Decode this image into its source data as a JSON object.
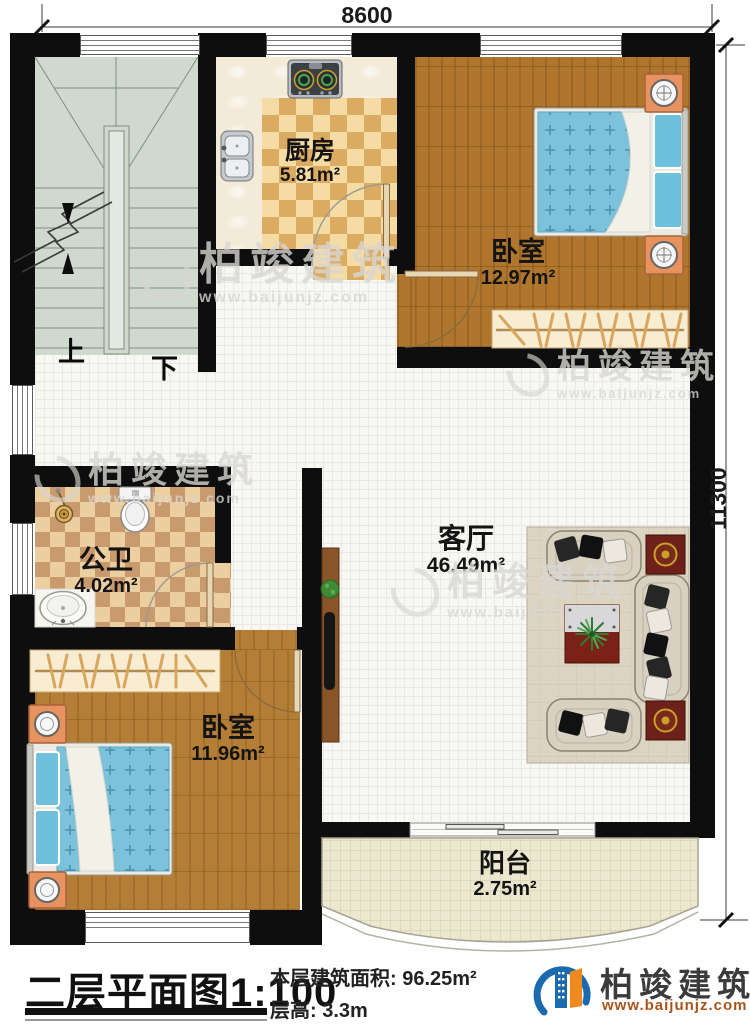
{
  "dimensions": {
    "top": "8600",
    "right": "11300"
  },
  "rooms": {
    "kitchen": {
      "name": "厨房",
      "area": "5.81m²"
    },
    "bedroom_top": {
      "name": "卧室",
      "area": "12.97m²"
    },
    "living": {
      "name": "客厅",
      "area": "46.49m²"
    },
    "bathroom": {
      "name": "公卫",
      "area": "4.02m²"
    },
    "bedroom_bottom": {
      "name": "卧室",
      "area": "11.96m²"
    },
    "balcony": {
      "name": "阳台",
      "area": "2.75m²"
    }
  },
  "stairs": {
    "up_label": "上",
    "down_label": "下"
  },
  "title_block": {
    "title": "二层平面图",
    "scale": "1:100",
    "area_line": "本层建筑面积: 96.25m²",
    "height_line": "层高: 3.3m"
  },
  "brand": {
    "name": "柏竣建筑",
    "url": "www.baijunjz.com"
  },
  "colors": {
    "wall": "#0e0e0e",
    "wood_floor": "#b0762e",
    "stair_floor": "#cfd9cd",
    "bed_blue": "#7cc2da",
    "brand_blue": "#1a6aad",
    "brand_orange": "#f08a1e",
    "brand_url_text": "#a8541c"
  }
}
